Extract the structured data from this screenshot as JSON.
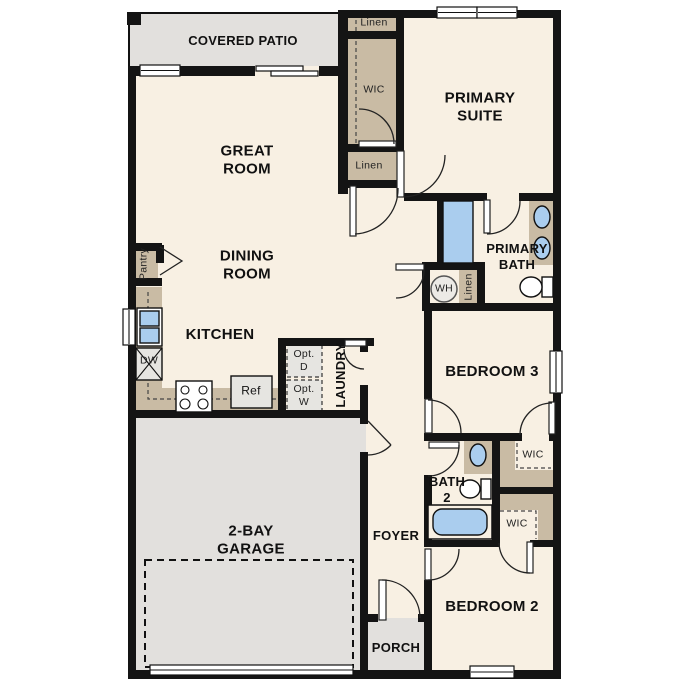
{
  "title": "Single-story floor plan",
  "colors": {
    "wall": "#141414",
    "floor": "#f8f0e3",
    "closet": "#c9bba4",
    "outdoor": "#e2e0dd",
    "fixture": "#aacdee",
    "appliance": "#e6e5e1"
  },
  "labels": {
    "covered_patio": "COVERED PATIO",
    "great_room": "GREAT ROOM",
    "dining_room": "DINING ROOM",
    "kitchen": "KITCHEN",
    "primary_suite": "PRIMARY SUITE",
    "primary_bath": "PRIMARY BATH",
    "bedroom3": "BEDROOM 3",
    "bedroom2": "BEDROOM 2",
    "bath2": "BATH 2",
    "laundry": "LAUNDRY",
    "foyer": "FOYER",
    "porch": "PORCH",
    "garage": "2-BAY GARAGE",
    "linen_top": "Linen",
    "linen_mid": "Linen",
    "linen_wh": "Linen",
    "wic_primary": "WIC",
    "wic_bed3": "WIC",
    "wic_bed2": "WIC",
    "pantry": "Pantry",
    "dishwasher": "DW",
    "refrigerator": "Ref",
    "opt_dryer": "Opt. D",
    "opt_washer": "Opt. W",
    "water_heater": "WH"
  }
}
